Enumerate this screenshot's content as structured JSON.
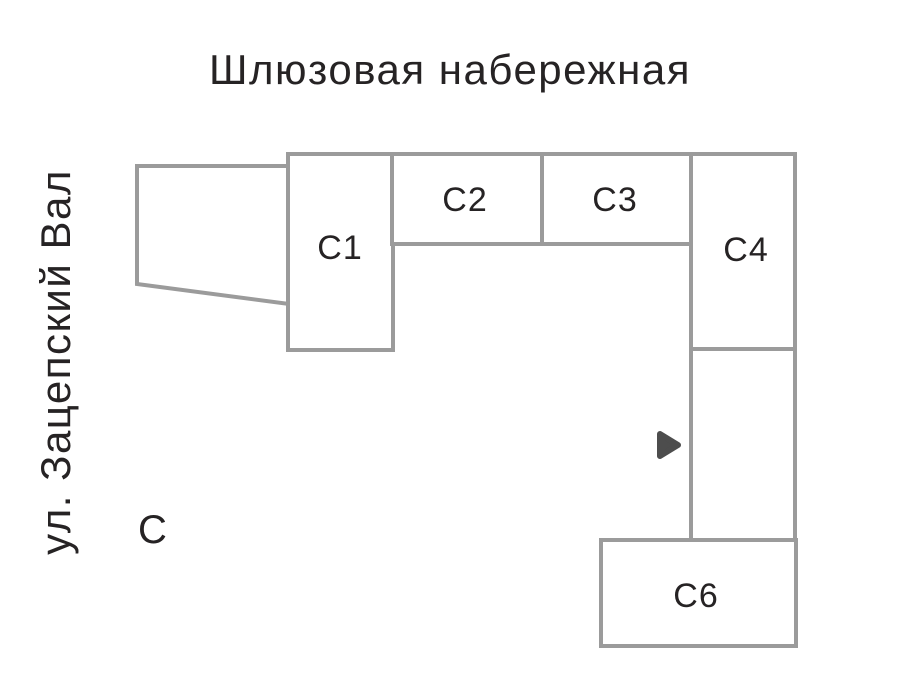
{
  "streets": {
    "top": "Шлюзовая набережная",
    "left": "ул. Зацепский Вал"
  },
  "compass": {
    "north": "С"
  },
  "buildings": [
    {
      "id": "c1",
      "label": "С1",
      "highlighted": false
    },
    {
      "id": "c2",
      "label": "С2",
      "highlighted": false
    },
    {
      "id": "c3",
      "label": "С3",
      "highlighted": false
    },
    {
      "id": "c4",
      "label": "С4",
      "highlighted": false
    },
    {
      "id": "c5",
      "label": "С5",
      "highlighted": true
    },
    {
      "id": "c6",
      "label": "С6",
      "highlighted": false
    }
  ],
  "marker": {
    "icon": "triangle-right",
    "target": "С5"
  },
  "colors": {
    "background": "#ffffff",
    "outline": "#9b9b9b",
    "text": "#262324",
    "highlight_fill": "#4d4d4d",
    "highlight_text": "#ffffff",
    "marker_fill": "#4d4d4d"
  }
}
